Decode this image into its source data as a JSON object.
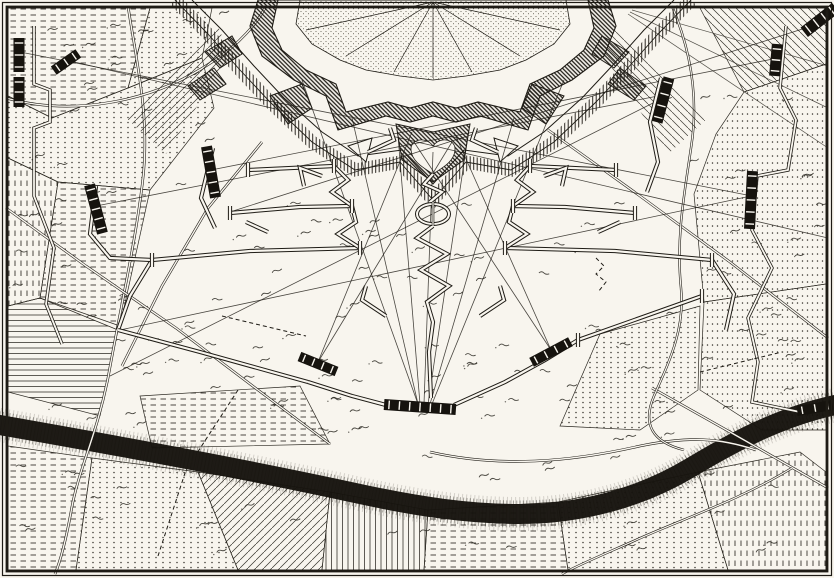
{
  "canvas": {
    "width": 834,
    "height": 578
  },
  "palette": {
    "paper": "#f8f5ee",
    "ink": "#1e1b15",
    "ink_soft": "#2c2922",
    "battery_fill": "#16130e",
    "river": "#17140e"
  },
  "frame": {
    "outer_inset": 2.5,
    "inner_inset": 7,
    "outer_width": 1.2,
    "inner_width": 2.8
  },
  "map": {
    "type": "engraved-siege-map",
    "seed": 11,
    "tuft_count": 250,
    "fortress": {
      "shape": "star-fort",
      "cx": 433,
      "features": [
        "glacis",
        "covered-way",
        "counterguards",
        "ravelins",
        "main-rampart",
        "town-center",
        "heart-demilune"
      ]
    },
    "fields": [
      {
        "pattern": "DashH",
        "pts": "8,8 150,8 128,88 52,118 8,96"
      },
      {
        "pattern": "DotsH",
        "pts": "150,8 212,8 202,58 128,88"
      },
      {
        "pattern": "DotsH",
        "pts": "8,96 52,118 128,88 202,58 214,108 150,190 58,182 8,158"
      },
      {
        "pattern": "DashV",
        "pts": "8,158 58,182 40,298 8,306"
      },
      {
        "pattern": "DashH",
        "pts": "58,182 150,190 120,326 40,298"
      },
      {
        "pattern": "LinesH",
        "pts": "8,306 40,298 118,330 100,416 8,392"
      },
      {
        "pattern": "DashH",
        "pts": "8,446 92,458 76,570 8,570"
      },
      {
        "pattern": "DotsH",
        "pts": "92,458 198,472 238,570 76,570"
      },
      {
        "pattern": "DiagA",
        "pts": "198,472 330,492 322,570 238,570"
      },
      {
        "pattern": "LinesV",
        "pts": "330,492 428,510 424,570 322,570"
      },
      {
        "pattern": "DashH",
        "pts": "428,510 558,502 568,570 424,570"
      },
      {
        "pattern": "DotsH",
        "pts": "558,502 698,472 728,570 568,570"
      },
      {
        "pattern": "DashV",
        "pts": "698,472 800,452 826,472 826,570 728,570"
      },
      {
        "pattern": "DotsV",
        "pts": "704,302 826,284 826,430 762,430 700,390"
      },
      {
        "pattern": "DotsV",
        "pts": "744,92 826,64 826,284 704,302 694,194 716,134"
      },
      {
        "pattern": "DiagB",
        "pts": "700,8 826,8 826,64 744,92"
      },
      {
        "pattern": "DashH",
        "pts": "140,396 300,386 330,444 152,448"
      },
      {
        "pattern": "DotsH",
        "pts": "600,334 700,306 698,390 640,430 560,426"
      }
    ],
    "glacis_rays": [
      [
        628,
        14,
        828,
        148
      ],
      [
        630,
        12,
        828,
        108
      ],
      [
        632,
        10,
        828,
        66
      ],
      [
        636,
        8,
        808,
        6
      ]
    ],
    "river": {
      "path": "M-6,424 C120,446 250,470 360,494 C420,507 470,514 520,514 C580,514 640,498 690,468 C730,444 780,416 840,404",
      "core_width": 20
    },
    "roads": [
      "M128,6 C136,60 150,115 143,178 C136,240 122,300 108,378 C96,438 78,470 71,512 C65,545 60,562 55,574",
      "M6,208 L86,266 176,328 258,390 330,444",
      "M262,142 L208,208 162,286 122,366",
      "M548,130 L640,196 730,262 828,338",
      "M652,388 L730,432 828,488",
      "M430,452 C500,468 570,462 640,446 C690,436 720,438 756,450",
      "M6,98 C70,116 150,104 212,62 C240,44 258,22 266,6"
    ],
    "streams": [
      "M672,6 C688,44 700,92 691,148 C684,196 676,238 681,288 C685,330 669,362 654,396 C642,424 652,442 684,450",
      "M792,468 C740,500 680,520 636,540 C600,556 576,566 562,574"
    ],
    "circumvallation": [
      "M34,26 L34,84 50,90 50,122 34,128 34,196 54,248 46,304 62,344",
      "M786,26 L780,88 796,120 788,170 757,176 752,230 772,268 748,318 758,362 752,402 800,412"
    ],
    "fire_lines": [
      [
        418,
        404,
        302,
        80
      ],
      [
        418,
        404,
        352,
        118
      ],
      [
        420,
        404,
        398,
        136
      ],
      [
        424,
        404,
        433,
        152
      ],
      [
        428,
        404,
        468,
        136
      ],
      [
        430,
        404,
        514,
        118
      ],
      [
        432,
        404,
        564,
        80
      ],
      [
        318,
        362,
        412,
        132
      ],
      [
        318,
        362,
        452,
        142
      ],
      [
        551,
        350,
        414,
        142
      ],
      [
        551,
        350,
        454,
        132
      ],
      [
        96,
        206,
        658,
        96
      ],
      [
        20,
        52,
        752,
        196
      ],
      [
        66,
        60,
        828,
        238
      ],
      [
        211,
        170,
        778,
        58
      ],
      [
        663,
        98,
        110,
        376
      ],
      [
        751,
        196,
        120,
        330
      ],
      [
        818,
        24,
        230,
        212
      ]
    ],
    "dashed_lines": [
      [
        [
          222,
          316
        ],
        [
          306,
          336
        ]
      ],
      [
        [
          700,
          372
        ],
        [
          782,
          352
        ]
      ],
      [
        [
          238,
          390
        ],
        [
          186,
          470
        ],
        [
          158,
          556
        ]
      ],
      [
        [
          596,
          258
        ],
        [
          604,
          266
        ],
        [
          596,
          274
        ],
        [
          606,
          282
        ],
        [
          598,
          292
        ]
      ]
    ],
    "trenches": [
      [
        [
          248,
          170
        ],
        [
          334,
          166
        ]
      ],
      [
        [
          530,
          166
        ],
        [
          616,
          170
        ]
      ],
      [
        [
          230,
          213
        ],
        [
          300,
          207
        ],
        [
          352,
          206
        ]
      ],
      [
        [
          513,
          206
        ],
        [
          565,
          207
        ],
        [
          635,
          213
        ]
      ],
      [
        [
          152,
          260
        ],
        [
          250,
          251
        ],
        [
          360,
          248
        ]
      ],
      [
        [
          505,
          248
        ],
        [
          615,
          251
        ],
        [
          712,
          260
        ]
      ],
      [
        [
          152,
          260
        ],
        [
          130,
          296
        ],
        [
          118,
          330
        ]
      ],
      [
        [
          118,
          330
        ],
        [
          200,
          352
        ],
        [
          308,
          382
        ]
      ],
      [
        [
          308,
          382
        ],
        [
          352,
          396
        ],
        [
          386,
          405
        ]
      ],
      [
        [
          454,
          405
        ],
        [
          505,
          382
        ],
        [
          545,
          360
        ],
        [
          578,
          340
        ]
      ],
      [
        [
          578,
          340
        ],
        [
          640,
          318
        ],
        [
          702,
          296
        ]
      ],
      [
        [
          712,
          260
        ],
        [
          734,
          294
        ],
        [
          726,
          330
        ]
      ],
      [
        [
          213,
          148
        ],
        [
          201,
          198
        ],
        [
          215,
          228
        ]
      ],
      [
        [
          96,
          186
        ],
        [
          90,
          234
        ],
        [
          110,
          258
        ],
        [
          152,
          260
        ]
      ],
      [
        [
          661,
          78
        ],
        [
          650,
          122
        ],
        [
          658,
          162
        ],
        [
          647,
          192
        ]
      ],
      [
        [
          368,
          152
        ],
        [
          394,
          140
        ],
        [
          390,
          128
        ]
      ],
      [
        [
          498,
          152
        ],
        [
          472,
          140
        ],
        [
          476,
          128
        ]
      ],
      [
        [
          322,
          176
        ],
        [
          300,
          168
        ],
        [
          304,
          186
        ]
      ],
      [
        [
          544,
          176
        ],
        [
          566,
          168
        ],
        [
          562,
          186
        ]
      ],
      [
        [
          268,
          232
        ],
        [
          246,
          222
        ]
      ],
      [
        [
          598,
          232
        ],
        [
          620,
          222
        ]
      ],
      [
        [
          386,
          316
        ],
        [
          362,
          300
        ],
        [
          366,
          286
        ]
      ],
      [
        [
          480,
          316
        ],
        [
          504,
          300
        ],
        [
          500,
          286
        ]
      ],
      [
        [
          433,
          174
        ],
        [
          424,
          184
        ],
        [
          442,
          192
        ],
        [
          430,
          202
        ]
      ],
      [
        [
          433,
          226
        ],
        [
          417,
          238
        ],
        [
          447,
          254
        ],
        [
          421,
          270
        ],
        [
          449,
          286
        ],
        [
          427,
          302
        ],
        [
          433,
          322
        ],
        [
          429,
          352
        ],
        [
          431,
          398
        ]
      ],
      [
        [
          352,
          206
        ],
        [
          332,
          192
        ],
        [
          348,
          180
        ],
        [
          334,
          166
        ]
      ],
      [
        [
          360,
          248
        ],
        [
          338,
          234
        ],
        [
          356,
          222
        ],
        [
          352,
          206
        ]
      ],
      [
        [
          513,
          206
        ],
        [
          533,
          192
        ],
        [
          517,
          180
        ],
        [
          530,
          166
        ]
      ],
      [
        [
          505,
          248
        ],
        [
          527,
          234
        ],
        [
          509,
          222
        ],
        [
          513,
          206
        ]
      ]
    ],
    "traverses": [
      [
        [
          248,
          163
        ],
        [
          248,
          177
        ]
      ],
      [
        [
          334,
          159
        ],
        [
          334,
          173
        ]
      ],
      [
        [
          530,
          159
        ],
        [
          530,
          173
        ]
      ],
      [
        [
          616,
          163
        ],
        [
          616,
          177
        ]
      ],
      [
        [
          230,
          206
        ],
        [
          230,
          220
        ]
      ],
      [
        [
          352,
          199
        ],
        [
          352,
          213
        ]
      ],
      [
        [
          513,
          199
        ],
        [
          513,
          213
        ]
      ],
      [
        [
          635,
          206
        ],
        [
          635,
          220
        ]
      ],
      [
        [
          152,
          253
        ],
        [
          152,
          267
        ]
      ],
      [
        [
          360,
          241
        ],
        [
          360,
          255
        ]
      ],
      [
        [
          505,
          241
        ],
        [
          505,
          255
        ]
      ],
      [
        [
          712,
          253
        ],
        [
          712,
          267
        ]
      ],
      [
        [
          578,
          333
        ],
        [
          578,
          347
        ]
      ],
      [
        [
          702,
          289
        ],
        [
          702,
          303
        ]
      ]
    ],
    "redoubt_oval": {
      "cx": 433,
      "cy": 214,
      "rx": 16,
      "ry": 10
    },
    "batteries": [
      [
        211,
        172,
        52,
        11,
        80
      ],
      [
        96,
        209,
        50,
        11,
        75
      ],
      [
        19,
        55,
        34,
        11,
        90
      ],
      [
        19,
        92,
        30,
        11,
        90
      ],
      [
        663,
        100,
        46,
        11,
        -75
      ],
      [
        776,
        60,
        32,
        11,
        -85
      ],
      [
        751,
        200,
        58,
        11,
        -87
      ],
      [
        820,
        20,
        40,
        12,
        -38
      ],
      [
        66,
        62,
        30,
        10,
        -35
      ],
      [
        420,
        407,
        72,
        11,
        4
      ],
      [
        318,
        364,
        40,
        10,
        22
      ],
      [
        551,
        352,
        44,
        10,
        -28
      ],
      [
        815,
        408,
        36,
        10,
        -10
      ]
    ]
  }
}
